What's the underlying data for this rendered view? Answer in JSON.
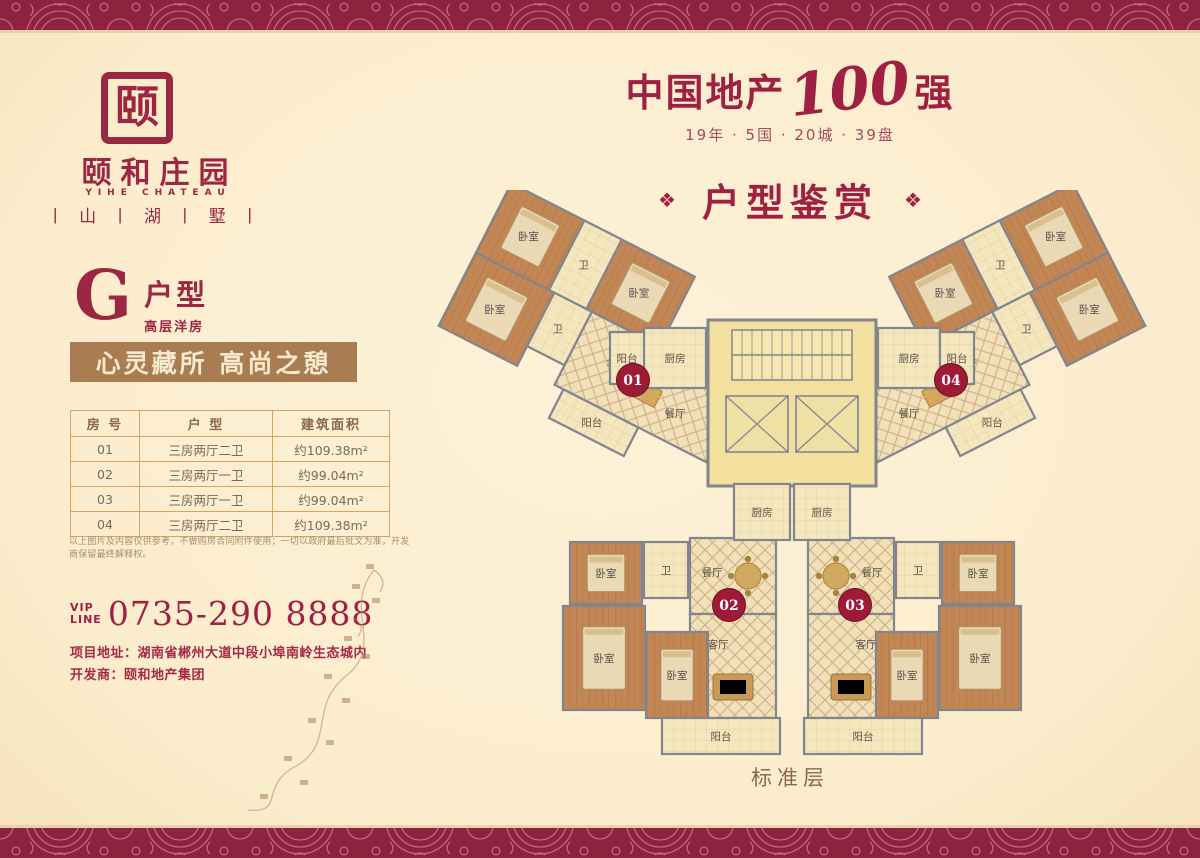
{
  "brand": {
    "seal_char": "颐",
    "name_cn": "颐和庄园",
    "name_en": "YIHE CHATEAU",
    "sub_brand": "丨 山 丨 湖 丨 墅 丨"
  },
  "unit": {
    "letter": "G",
    "type_label": "户型",
    "sub_label": "高层洋房"
  },
  "slogan": "心灵藏所  高尚之憩",
  "table": {
    "headers": [
      "房 号",
      "户 型",
      "建筑面积"
    ],
    "rows": [
      [
        "01",
        "三房两厅二卫",
        "约109.38m²"
      ],
      [
        "02",
        "三房两厅一卫",
        "约99.04m²"
      ],
      [
        "03",
        "三房两厅一卫",
        "约99.04m²"
      ],
      [
        "04",
        "三房两厅二卫",
        "约109.38m²"
      ]
    ]
  },
  "disclaimer": "以上图片及内容仅供参考，不做购房合同附件使用；一切以政府最后批文为准，开发商保留最终解释权。",
  "contact": {
    "vip_top": "VIP",
    "vip_bottom": "LINE",
    "phone": "0735-290 8888",
    "address_label": "项目地址：",
    "address_value": "湖南省郴州大道中段小埠南岭生态城内",
    "developer_label": "开发商：",
    "developer_value": "颐和地产集团"
  },
  "headline": {
    "prefix": "中国地产",
    "number": "100",
    "suffix": "强",
    "subtitle": "19年 · 5国 · 20城 · 39盘"
  },
  "section": {
    "title": "户型鉴赏",
    "ornament": "❖"
  },
  "floorplan": {
    "labels": {
      "bedroom": "卧室",
      "bath": "卫",
      "balcony": "阳台",
      "kitchen": "厨房",
      "dining": "餐厅",
      "living": "客厅"
    },
    "badges": [
      "01",
      "02",
      "03",
      "04"
    ],
    "footer": "标准层"
  },
  "colors": {
    "accent": "#9e2143",
    "band": "#8e2340",
    "banner": "#aa7c52",
    "badge": "#9e1a36"
  }
}
